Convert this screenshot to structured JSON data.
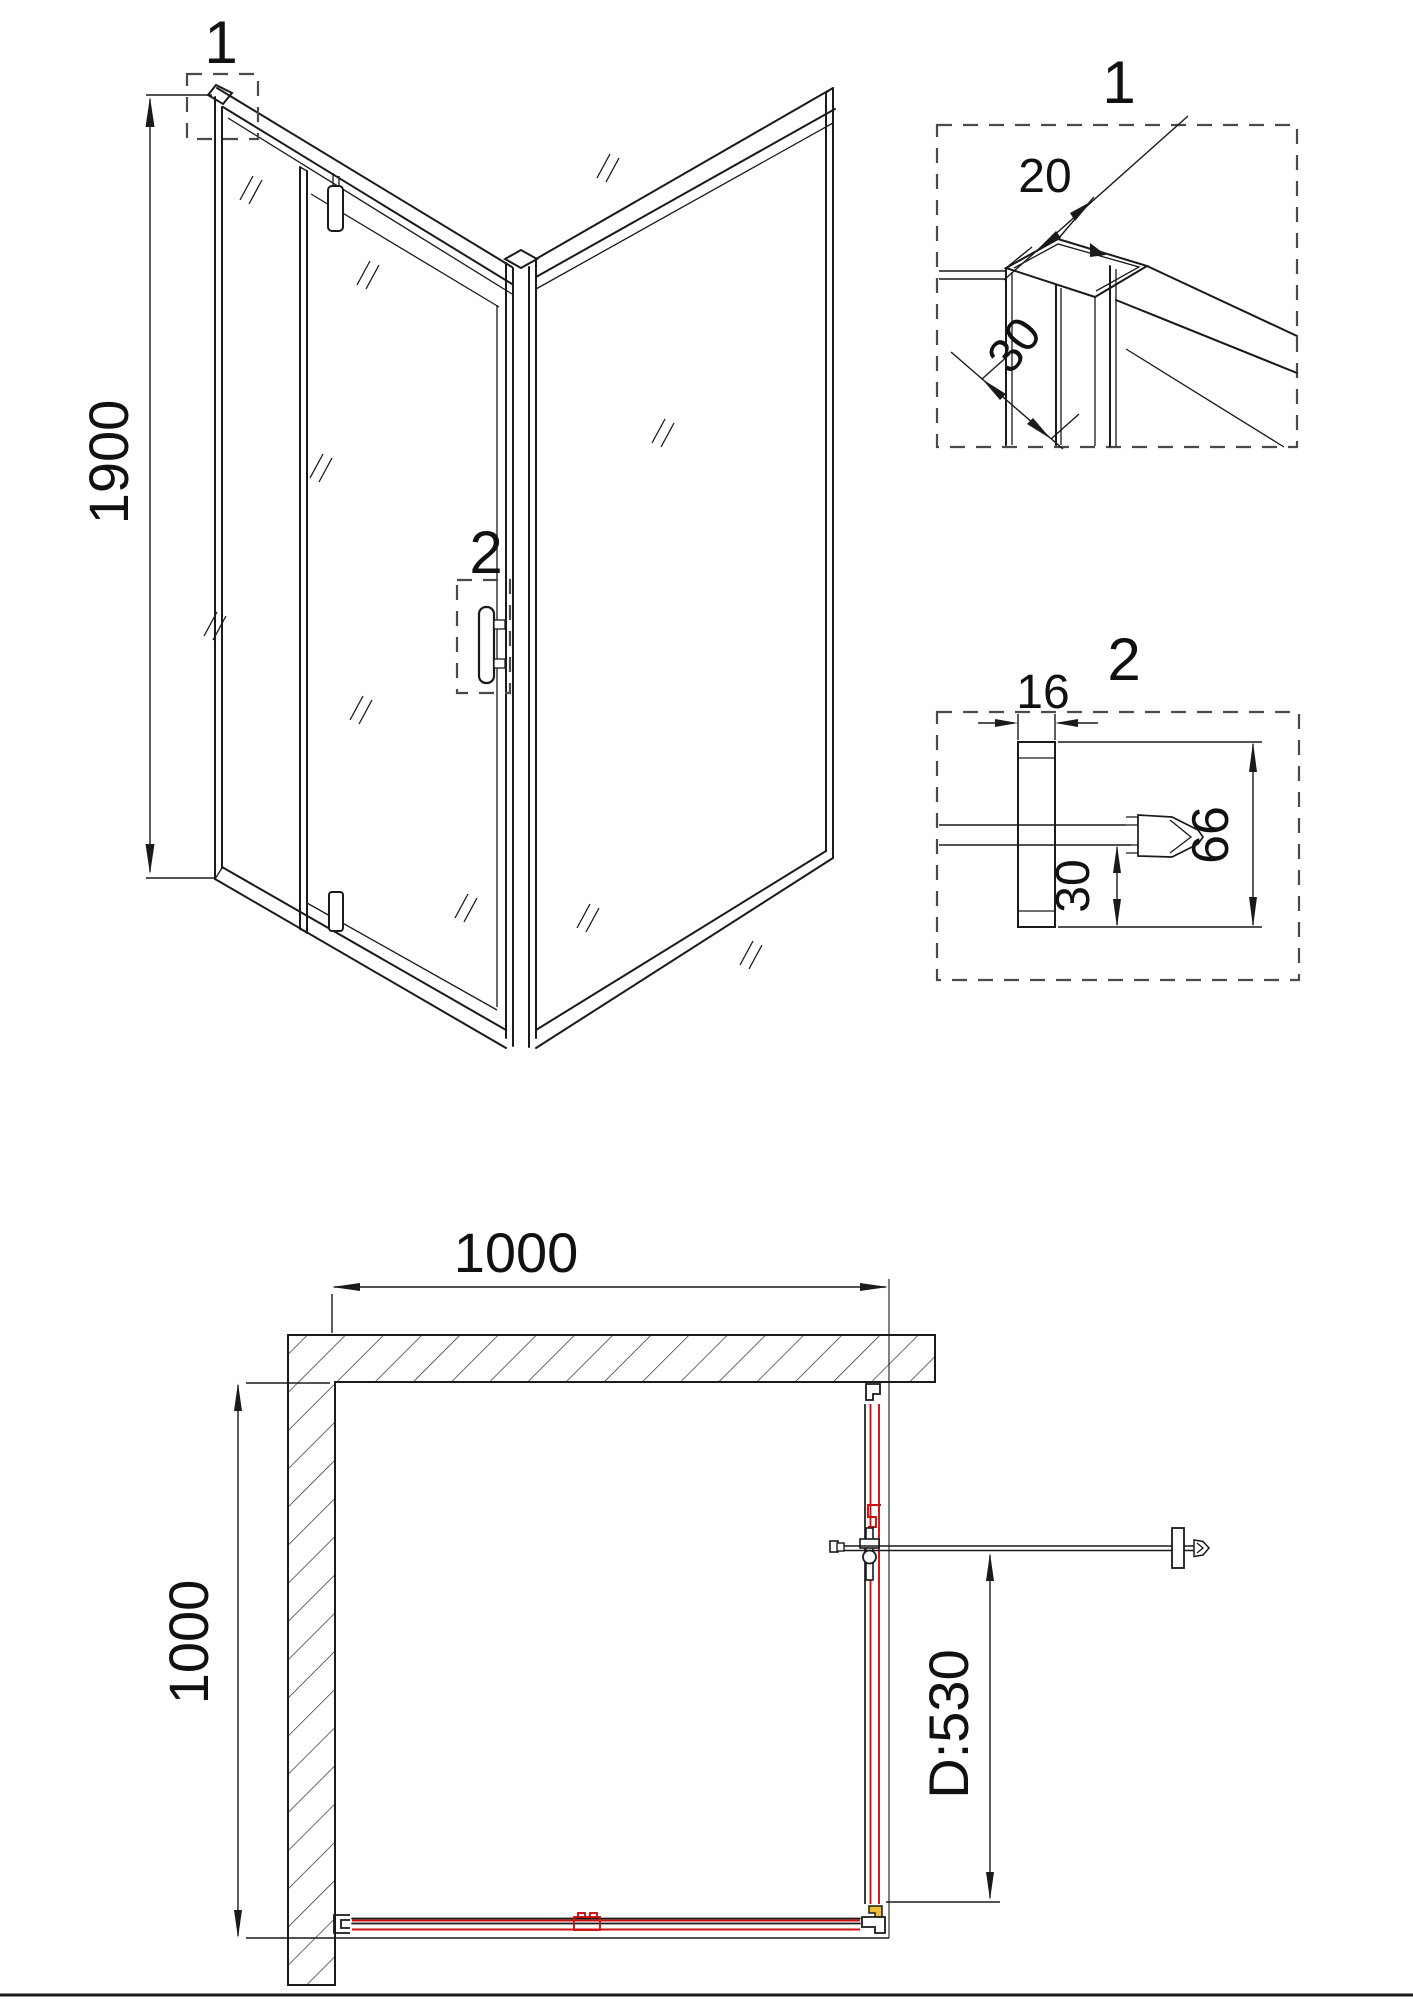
{
  "drawing": {
    "type": "shower-enclosure-technical-drawing",
    "views": {
      "elevation": {
        "callout_1": "1",
        "callout_2": "2",
        "height_dim": "1900"
      },
      "detail_1": {
        "label": "1",
        "profile_width_dim": "20",
        "profile_depth_dim": "30"
      },
      "detail_2": {
        "label": "2",
        "profile_width_dim": "16",
        "bottom_offset_dim": "30",
        "total_height_dim": "66"
      },
      "plan": {
        "width_dim": "1000",
        "depth_dim": "1000",
        "door_dim": "D:530"
      }
    },
    "colors": {
      "line": "#1a1a1a",
      "glass_accent_red": "#cc1111",
      "connector_accent_yellow": "#ecbe30",
      "callout_dash": "#4a4a4a"
    }
  }
}
